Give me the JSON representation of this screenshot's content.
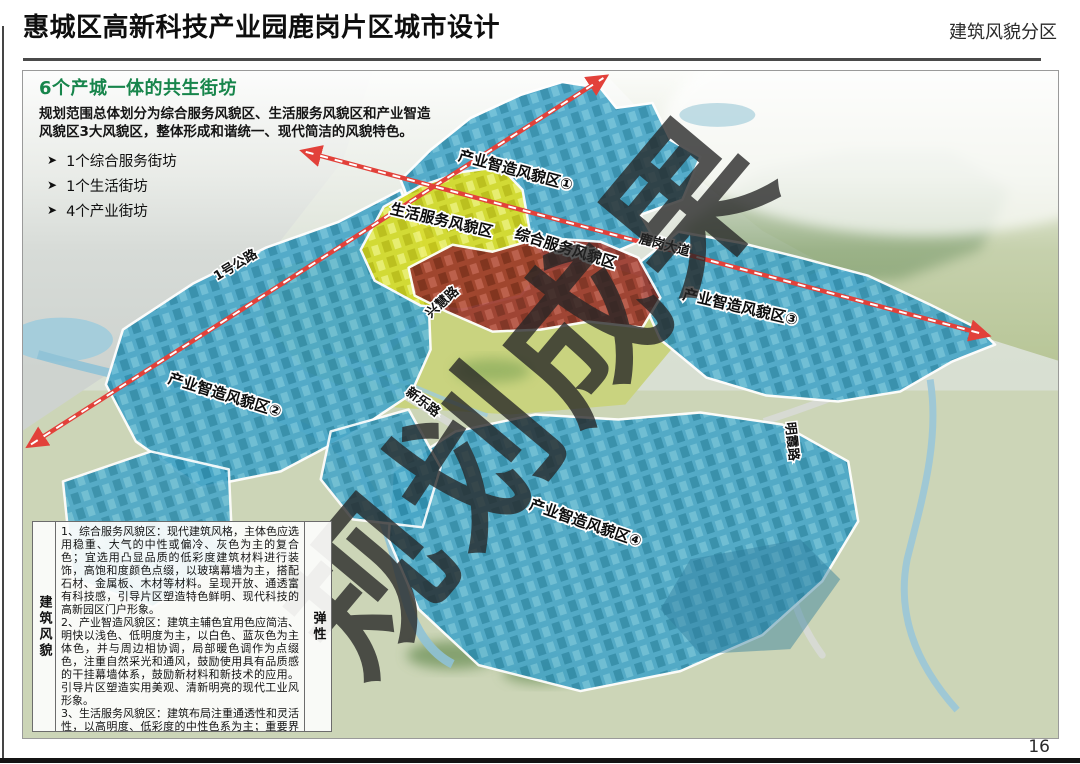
{
  "header": {
    "title": "惠城区高新科技产业园鹿岗片区城市设计",
    "section": "建筑风貌分区"
  },
  "intro": {
    "heading": "6个产城一体的共生街坊",
    "body": "规划范围总体划分为综合服务风貌区、生活服务风貌区和产业智造风貌区3大风貌区，整体形成和谐统一、现代简洁的风貌特色。",
    "bullets": [
      {
        "marker": "➤",
        "label": "1个综合服务街坊"
      },
      {
        "marker": "➤",
        "label": "1个生活街坊"
      },
      {
        "marker": "➤",
        "label": "4个产业街坊"
      }
    ]
  },
  "map": {
    "zone_labels": [
      {
        "text": "产业智造风貌区①"
      },
      {
        "text": "生活服务风貌区"
      },
      {
        "text": "综合服务风貌区"
      },
      {
        "text": "产业智造风貌区③"
      },
      {
        "text": "产业智造风貌区②"
      },
      {
        "text": "产业智造风貌区④"
      }
    ],
    "road_labels": [
      {
        "text": "1号公路"
      },
      {
        "text": "鹿岗大道"
      },
      {
        "text": "兴慧路"
      },
      {
        "text": "新乐路"
      },
      {
        "text": "明霞路"
      }
    ],
    "watermark": "规划成果",
    "zone_colors": {
      "industry_blue": "#4aa7c8",
      "living_yellow": "#d9dd2e",
      "service_red": "#9c3a2e",
      "highway_red": "#e2413a"
    }
  },
  "legend": {
    "left_label": "建筑风貌",
    "right_label": "弹性",
    "paragraphs": [
      "1、综合服务风貌区：现代建筑风格，主体色应选用稳重、大气的中性或偏冷、灰色为主的复合色；宜选用凸显品质的低彩度建筑材料进行装饰，高饱和度颜色点缀，以玻璃幕墙为主，搭配石材、金属板、木材等材料。呈现开放、通透富有科技感，引导片区塑造特色鲜明、现代科技的高新园区门户形象。",
      "2、产业智造风貌区：建筑主辅色宜用色应简洁、明快以浅色、低明度为主，以白色、蓝灰色为主体色，并与周边相协调，局部暖色调作为点缀色，注重自然采光和通风，鼓励使用具有品质感的干挂幕墙体系，鼓励新材料和新技术的应用。引导片区塑造实用美观、清新明亮的现代工业风形象。",
      "3、生活服务风貌区：建筑布局注重通透性和灵活性，以高明度、低彩度的中性色系为主；重要界面建筑外立面应当进行公建化设计，采用玻璃等材质，塑造时尚、雅致精美、宜居活力的生活区风貌。"
    ]
  },
  "page": {
    "number": "16"
  }
}
